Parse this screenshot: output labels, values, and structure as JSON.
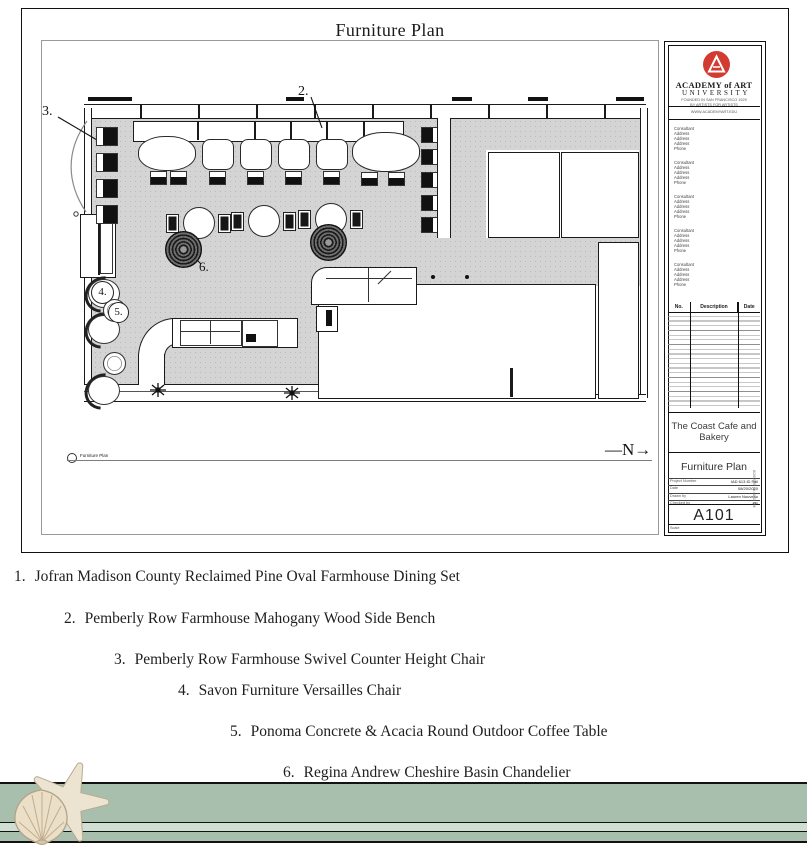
{
  "page": {
    "title": "Furniture Plan"
  },
  "plan": {
    "labels": {
      "l1": "1.",
      "l2": "2.",
      "l3": "3.",
      "l4": "4.",
      "l5": "5.",
      "l6": "6."
    },
    "north": "—N→",
    "view_title": "Furniture Plan"
  },
  "title_block": {
    "university": {
      "name_line1": "ACADEMY of ART",
      "name_line2": "UNIVERSITY",
      "tagline1": "FOUNDED IN SAN FRANCISCO 1929",
      "tagline2": "BY ARTISTS FOR ARTISTS",
      "website": "WWW.ACADEMYART.EDU"
    },
    "consultants": [
      {
        "lines": [
          "Consultant",
          "Address",
          "Address",
          "Address",
          "Phone"
        ]
      },
      {
        "lines": [
          "Consultant",
          "Address",
          "Address",
          "Address",
          "Phone"
        ]
      },
      {
        "lines": [
          "Consultant",
          "Address",
          "Address",
          "Address",
          "Phone"
        ]
      },
      {
        "lines": [
          "Consultant",
          "Address",
          "Address",
          "Address",
          "Phone"
        ]
      },
      {
        "lines": [
          "Consultant",
          "Address",
          "Address",
          "Address",
          "Phone"
        ]
      }
    ],
    "revisions": {
      "headers": [
        "No.",
        "Description",
        "Date"
      ]
    },
    "project_name": "The Coast Cafe and Bakery",
    "sheet_title": "Furniture Plan",
    "fields": [
      {
        "label": "Project Number",
        "value": "IAD 613 ID Fall"
      },
      {
        "label": "Date",
        "value": "08/20/2020"
      },
      {
        "label": "Drawn by",
        "value": "Lauren Nouveau"
      },
      {
        "label": "Checked by",
        "value": "KR"
      }
    ],
    "sheet_number": "A101",
    "scale_label": "Scale",
    "side_note": "8/20/2020 10:48:43 PM"
  },
  "furniture_list": [
    {
      "num": "1.",
      "text": "Jofran Madison County Reclaimed Pine Oval Farmhouse Dining Set"
    },
    {
      "num": "2.",
      "text": "Pemberly Row Farmhouse Mahogany Wood Side Bench"
    },
    {
      "num": "3.",
      "text": "Pemberly Row Farmhouse Swivel Counter Height Chair"
    },
    {
      "num": "4.",
      "text": "Savon Furniture Versailles Chair"
    },
    {
      "num": "5.",
      "text": "Ponoma Concrete & Acacia Round Outdoor Coffee Table"
    },
    {
      "num": "6.",
      "text": "Regina Andrew Cheshire Basin Chandelier"
    }
  ],
  "colors": {
    "accent_red": "#d23b31",
    "floor_gray": "#d4d4d4",
    "footer_green": "#a9bfad",
    "footer_stripe": "#cfdfd1"
  }
}
